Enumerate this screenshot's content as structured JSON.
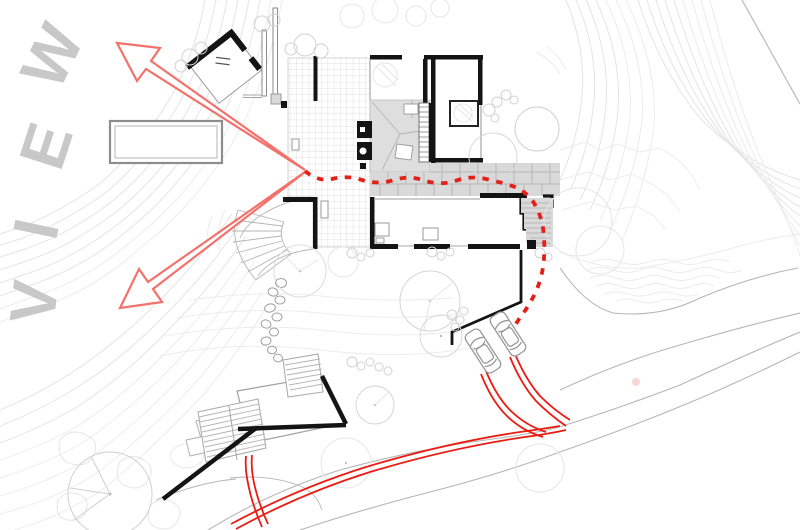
{
  "view_label": {
    "word": "VIEW",
    "letters": [
      "W",
      "E",
      "I",
      "V"
    ]
  },
  "colors": {
    "accent_red": "#ea1c14",
    "dash_red": "#e32017",
    "arrow_red": "#f4716b",
    "wall_black": "#141414",
    "contour_gray": "#e4e4e4",
    "road_gray": "#b5b5b5",
    "label_gray": "#c8c8c8",
    "paving_gray": "#d9d9d9",
    "pink_dot": "#f6d7d3"
  },
  "features": {
    "view_arrows_count": 2,
    "cars_count": 2,
    "stepping_stones_count": 10,
    "circulation_path_style": "red-dashed",
    "driveway_style": "red-double-line"
  }
}
